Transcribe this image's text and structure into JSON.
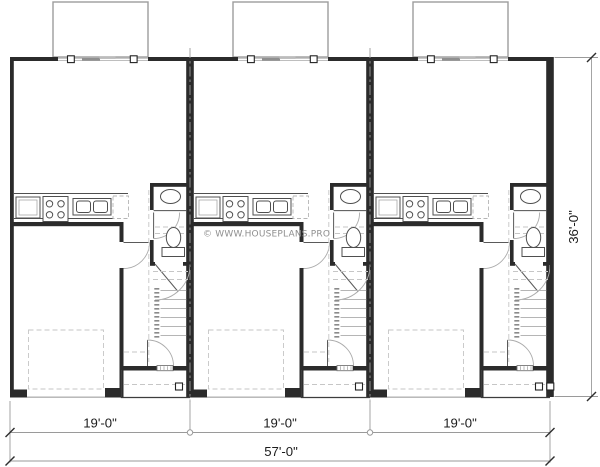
{
  "plan": {
    "watermark": "© WWW.HOUSEPLANS.PRO",
    "units_count": 3
  },
  "dimensions": {
    "unit_widths": [
      "19'-0\"",
      "19'-0\"",
      "19'-0\""
    ],
    "total_width": "57'-0\"",
    "depth": "36'-0\""
  },
  "colors": {
    "wall": "#2b2b2b",
    "fixture": "#4f4f4f",
    "light": "#9c9c9c",
    "dashed": "#c6c6c6",
    "dim": "#9a9a9a",
    "text": "#1c1c1c",
    "wm": "#8f8f8f",
    "bg": "#ffffff"
  }
}
